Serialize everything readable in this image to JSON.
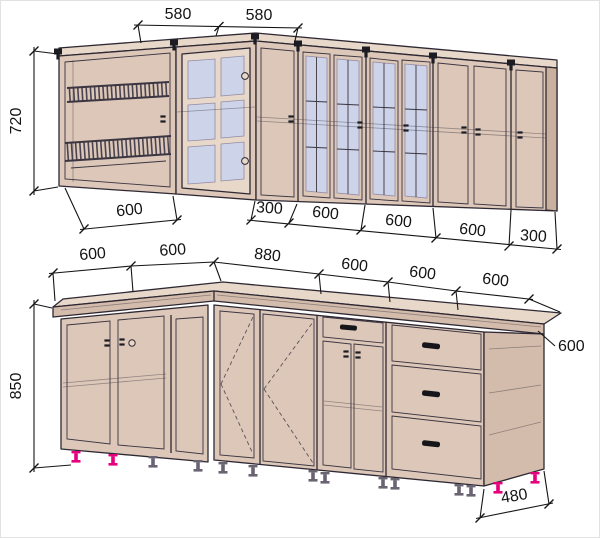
{
  "palette": {
    "cabinet_face": "#dcc7b8",
    "cabinet_face_light": "#e7d8ca",
    "cabinet_face_dark": "#c9b09f",
    "glass": "#cdd4e9",
    "outline": "#2e2833",
    "dimension_text": "#141414",
    "leg_accent_pink": "#e5007d",
    "background": "#ffffff"
  },
  "upper_view": {
    "top_dims": [
      "580",
      "580"
    ],
    "height_dim": "720",
    "bottom_dims": [
      "600",
      "300",
      "600",
      "600",
      "600",
      "300"
    ]
  },
  "lower_view": {
    "top_dims": [
      "600",
      "600",
      "880",
      "600",
      "600"
    ],
    "counter_end_depth_dim": "600",
    "counter_depth_leader_dim": "600",
    "height_dim": "850",
    "base_depth_dim": "480"
  }
}
